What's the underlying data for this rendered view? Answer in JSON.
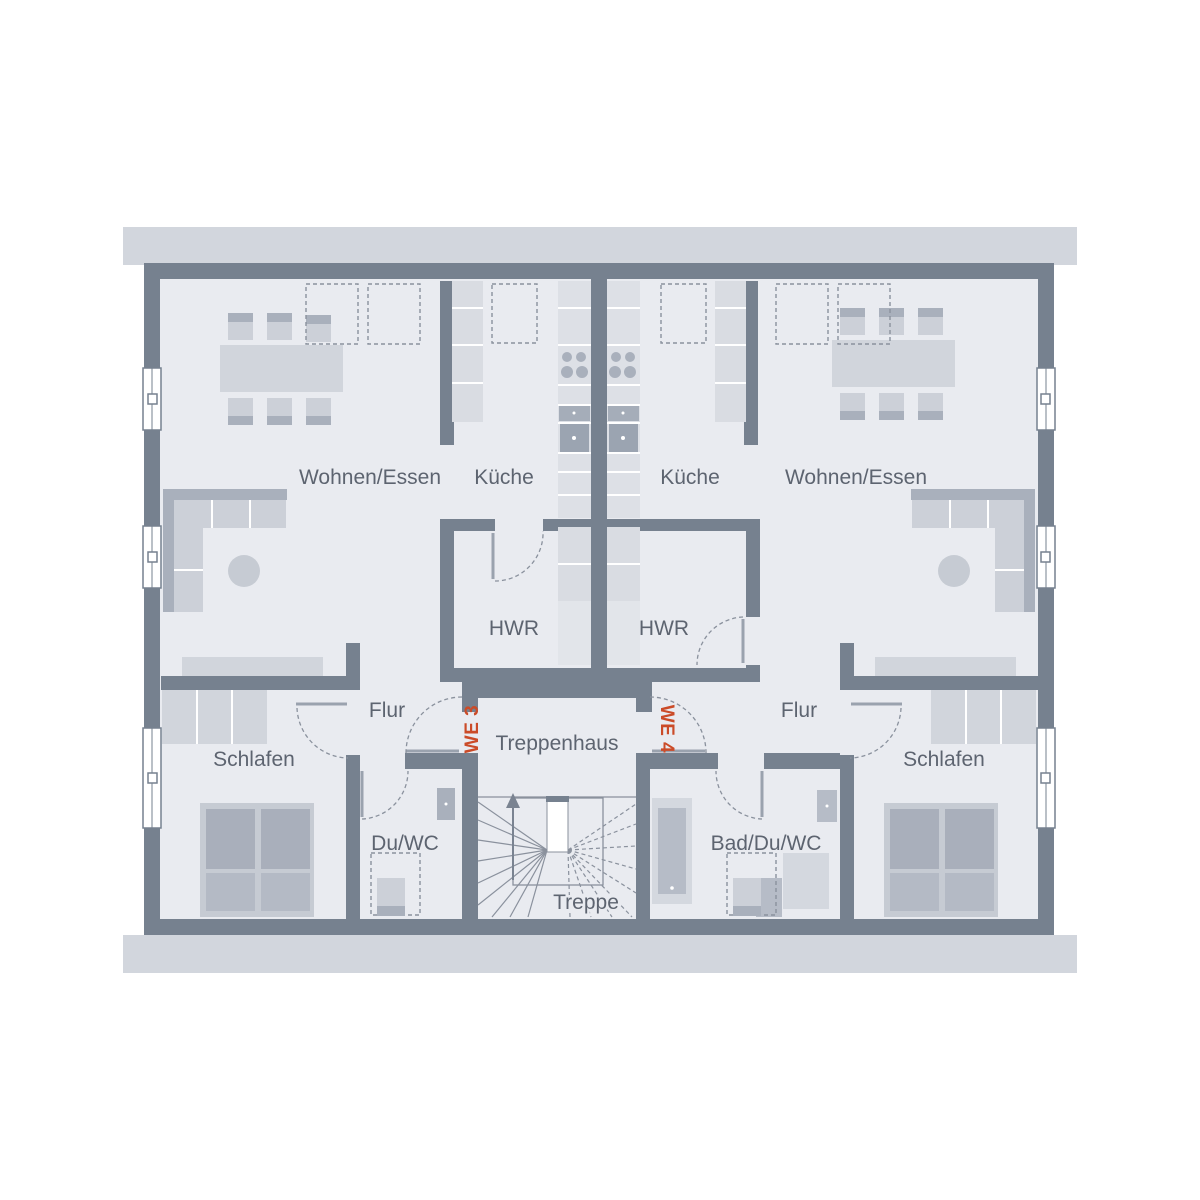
{
  "colors": {
    "wall": "#76818f",
    "floor": "#e9ebf0",
    "band": "#d2d6dd",
    "accent": "#cb4b28",
    "label_text": "#5d6470"
  },
  "rooms": [
    {
      "id": "wohnen-essen-we3",
      "label": "Wohnen/Essen"
    },
    {
      "id": "kueche-we3",
      "label": "Küche"
    },
    {
      "id": "kueche-we4",
      "label": "Küche"
    },
    {
      "id": "wohnen-essen-we4",
      "label": "Wohnen/Essen"
    },
    {
      "id": "hwr-we3",
      "label": "HWR"
    },
    {
      "id": "hwr-we4",
      "label": "HWR"
    },
    {
      "id": "flur-we3",
      "label": "Flur"
    },
    {
      "id": "flur-we4",
      "label": "Flur"
    },
    {
      "id": "schlafen-we3",
      "label": "Schlafen"
    },
    {
      "id": "schlafen-we4",
      "label": "Schlafen"
    },
    {
      "id": "du-wc-we3",
      "label": "Du/WC"
    },
    {
      "id": "bad-du-wc-we4",
      "label": "Bad/Du/WC"
    },
    {
      "id": "treppenhaus",
      "label": "Treppenhaus"
    },
    {
      "id": "treppe",
      "label": "Treppe"
    }
  ],
  "unit_markers": [
    {
      "id": "we3",
      "label": "WE 3"
    },
    {
      "id": "we4",
      "label": "WE 4"
    }
  ]
}
